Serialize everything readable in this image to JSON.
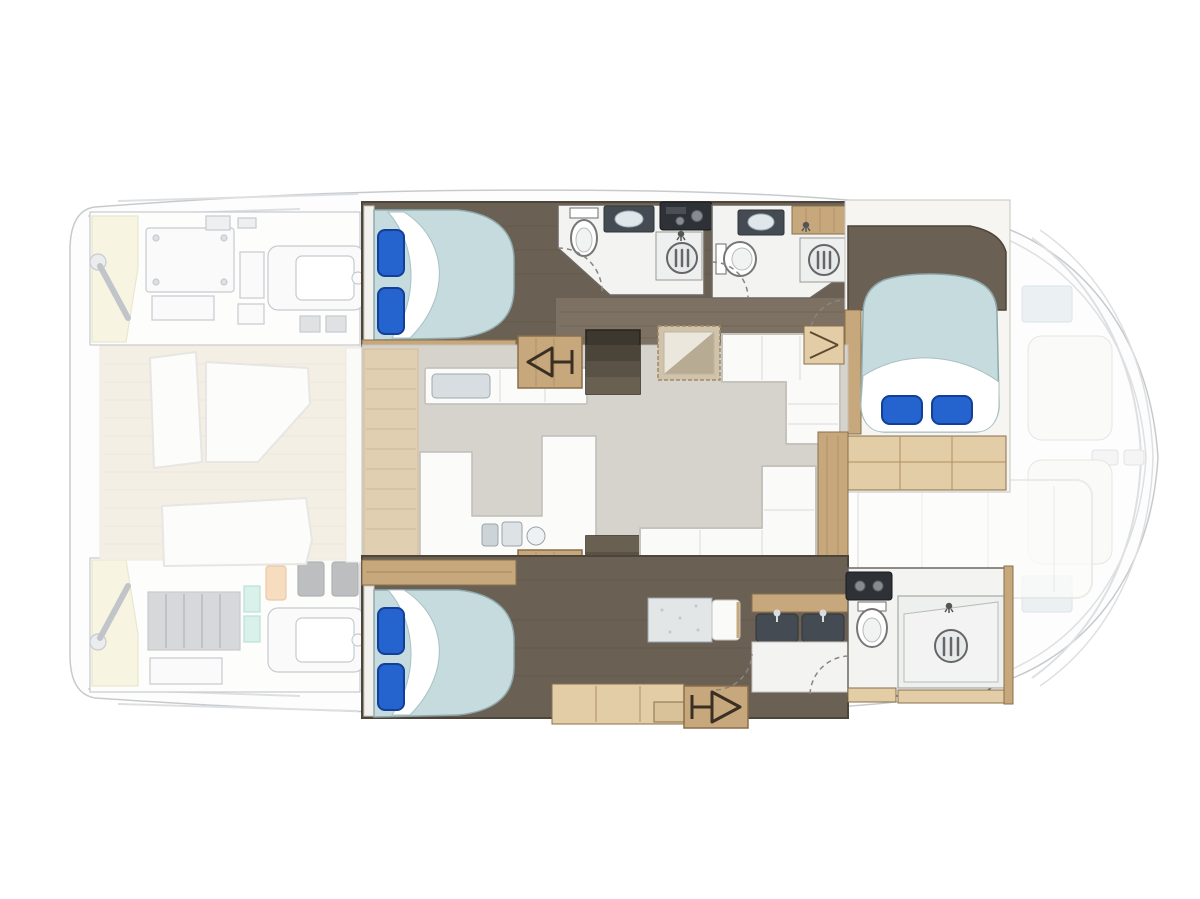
{
  "meta": {
    "description": "Top-view interior floor plan of a catamaran yacht: two hulls with cabins and bathrooms, central salon with galley and sofas, faded engine rooms aft and lounge decks at bow and stern"
  },
  "colors": {
    "floorDark": "#6b6054",
    "floorWalk": "#7d7164",
    "floorEdge": "#4d443a",
    "floorSalon": "#d6d3cd",
    "wood": "#c7a87d",
    "woodLight": "#e2cda6",
    "woodDark": "#8a6f4b",
    "woodGrain": "#b08f63",
    "bed": "#c6dbdd",
    "bedStroke": "#8fa9ad",
    "sheet": "#ffffff",
    "sheetStroke": "#a8c0c4",
    "pillow": "#2563cf",
    "pillowDark": "#123f97",
    "counter": "#fbfbf9",
    "counterStroke": "#c0bdb7",
    "bath": "#f3f3f1",
    "bathStroke": "#8a857d",
    "fixture": "#6e6e6a",
    "sinkBasin": "#454b52",
    "basinGlass": "#dfe7ea",
    "appliance": "#2e3237",
    "knob": "#858b91",
    "stairs1": "#3c372f",
    "stairs2": "#4b4439",
    "stairs3": "#5a5246",
    "stairs4": "#696052",
    "arrow": "#3a2f22",
    "tableTop": "#cfc3ae",
    "tableEdge": "#a38a5f",
    "mirrorHi": "#ece7dc",
    "mirrorLo": "#b7ab93",
    "deckTeak": "#ece2d0",
    "deckLine": "#ddd2bd",
    "lounge": "#fafaf8",
    "loungeStroke": "#d5d2cb",
    "fadedStroke": "#c3c7cb",
    "hullStroke": "#9aa0a6",
    "machine": "#9aa0a8",
    "machineFill": "#f6f7f8",
    "cream": "#f1eecb",
    "teal": "#b9e6da",
    "orange": "#f2c28c",
    "battery": "#b7babd",
    "glassBlue": "#dce6ea",
    "wall": "#6d675f",
    "entryWood": "#e3cfae",
    "deskTop": "#e2e6e7"
  },
  "vessel": {
    "type": "catamaran floor plan, top view, bow to the right",
    "port_hull": {
      "rooms": [
        "aft double-berth cabin",
        "aft head with shower and toilet",
        "forward head with shower and toilet",
        "forward double-berth cabin"
      ],
      "furniture": [
        "double bed with two blue pillows",
        "hanging locker with hanger symbol",
        "toilet",
        "vanity sink",
        "shower with round drain",
        "cooktop appliance",
        "double bed with two blue pillows",
        "slatted bench"
      ]
    },
    "main_deck": {
      "rooms": [
        "salon with galley",
        "aft cockpit (faded)",
        "bow lounge (faded)"
      ],
      "furniture": [
        "upper galley counter with sink",
        "lower U-shaped galley counter with bottles",
        "square mirror-top table",
        "L-shaped sofa forward",
        "L-shaped sofa aft",
        "port companionway stairs",
        "starboard companionway stairs",
        "corner locker",
        "sideboard trim"
      ]
    },
    "starboard_hull": {
      "rooms": [
        "aft double-berth cabin",
        "corridor with desk",
        "forward head with shower"
      ],
      "furniture": [
        "double bed with two blue pillows",
        "desk with seat",
        "twin-sink vanity",
        "wardrobe",
        "hanging locker with hanger symbol",
        "toilet",
        "shower with round drain",
        "water heater appliance"
      ]
    },
    "exterior_faded": {
      "areas": [
        "port engine room with steering gear and liferaft locker",
        "starboard engine room with battery bank and engine",
        "aft deck with lounge seats",
        "foredeck with trampoline, hatches and sun pads",
        "bow seating"
      ]
    }
  }
}
